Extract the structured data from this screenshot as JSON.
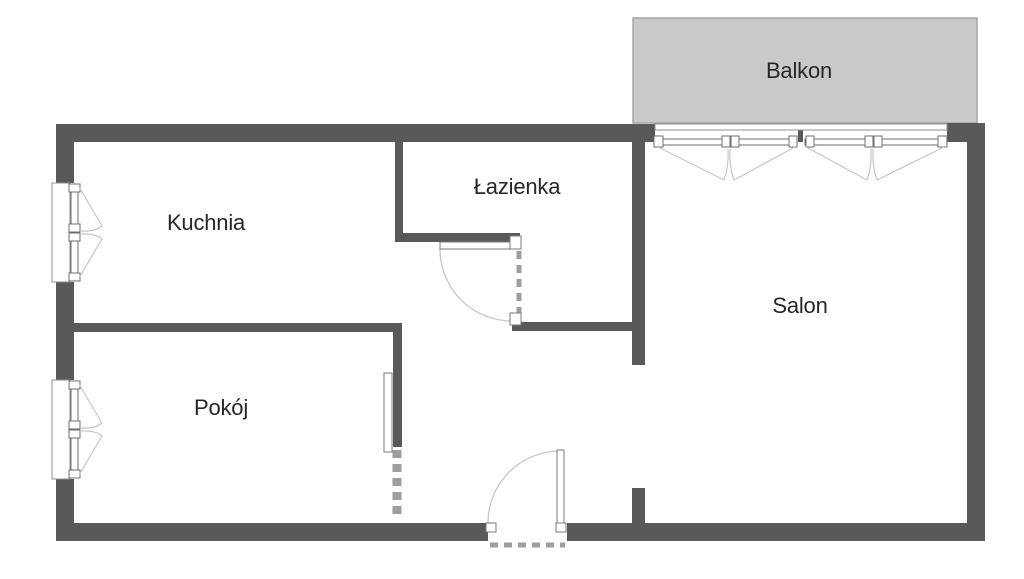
{
  "canvas": {
    "width": 1024,
    "height": 579
  },
  "colors": {
    "wall": "#595959",
    "balcony_fill": "#c9c9c9",
    "balcony_stroke": "#a6a6a6",
    "white": "#ffffff",
    "frame": "#6e6e6e",
    "frame_light": "#8f8f8f",
    "door_frame": "#7a7a7a",
    "swing": "#c6c6c6",
    "dash": "#9e9e9e",
    "label_text": "#262626"
  },
  "rooms": [
    {
      "id": "balkon",
      "name": "Balkon",
      "x": 799,
      "y": 71
    },
    {
      "id": "kuchnia",
      "name": "Kuchnia",
      "x": 206,
      "y": 223
    },
    {
      "id": "lazienka",
      "name": "Łazienka",
      "x": 517,
      "y": 187
    },
    {
      "id": "pokoj",
      "name": "Pokój",
      "x": 221,
      "y": 408
    },
    {
      "id": "salon",
      "name": "Salon",
      "x": 800,
      "y": 306
    }
  ],
  "shapes": [
    {
      "n": "balcony-slab",
      "t": "rect",
      "x": 633,
      "y": 18,
      "w": 344,
      "h": 105,
      "f": "balcony_fill",
      "s": "balcony_stroke",
      "sw": 1.5
    },
    {
      "n": "wall-top",
      "t": "rect",
      "x": 56,
      "y": 124,
      "w": 599,
      "h": 18,
      "f": "wall"
    },
    {
      "n": "wall-top-mullion",
      "t": "rect",
      "x": 798,
      "y": 124,
      "w": 5,
      "h": 18,
      "f": "wall"
    },
    {
      "n": "wall-top-right",
      "t": "rect",
      "x": 947,
      "y": 123,
      "w": 38,
      "h": 19,
      "f": "wall"
    },
    {
      "n": "wall-left-upper",
      "t": "rect",
      "x": 56,
      "y": 124,
      "w": 18,
      "h": 59,
      "f": "wall"
    },
    {
      "n": "wall-left-middle",
      "t": "rect",
      "x": 56,
      "y": 282,
      "w": 18,
      "h": 98,
      "f": "wall"
    },
    {
      "n": "wall-left-lower",
      "t": "rect",
      "x": 56,
      "y": 479,
      "w": 18,
      "h": 62,
      "f": "wall"
    },
    {
      "n": "wall-right",
      "t": "rect",
      "x": 967,
      "y": 123,
      "w": 18,
      "h": 418,
      "f": "wall"
    },
    {
      "n": "wall-bottom-left",
      "t": "rect",
      "x": 56,
      "y": 523,
      "w": 432,
      "h": 18,
      "f": "wall"
    },
    {
      "n": "wall-bottom-right",
      "t": "rect",
      "x": 567,
      "y": 523,
      "w": 418,
      "h": 18,
      "f": "wall"
    },
    {
      "n": "wall-bathroom-west",
      "t": "rect",
      "x": 395,
      "y": 142,
      "w": 8,
      "h": 100,
      "f": "wall"
    },
    {
      "n": "wall-bathroom-south",
      "t": "rect",
      "x": 395,
      "y": 233,
      "w": 125,
      "h": 9,
      "f": "wall"
    },
    {
      "n": "wall-hall-south",
      "t": "rect",
      "x": 512,
      "y": 322,
      "w": 133,
      "h": 9,
      "f": "wall"
    },
    {
      "n": "wall-salon-west-upper",
      "t": "rect",
      "x": 632,
      "y": 142,
      "w": 13,
      "h": 223,
      "f": "wall"
    },
    {
      "n": "wall-salon-west-lower",
      "t": "rect",
      "x": 632,
      "y": 488,
      "w": 13,
      "h": 35,
      "f": "wall"
    },
    {
      "n": "wall-room-divider",
      "t": "rect",
      "x": 74,
      "y": 323,
      "w": 328,
      "h": 9,
      "f": "wall"
    },
    {
      "n": "wall-pokoj-east",
      "t": "rect",
      "x": 393,
      "y": 323,
      "w": 9,
      "h": 124,
      "f": "wall"
    },
    {
      "n": "window-kitchen-sill",
      "t": "rect",
      "x": 52,
      "y": 183,
      "w": 18,
      "h": 99,
      "f": "white",
      "s": "frame_light",
      "sw": 1
    },
    {
      "n": "window-kitchen-pane",
      "t": "rect",
      "x": 71,
      "y": 185,
      "w": 7,
      "h": 95,
      "f": "white",
      "s": "frame",
      "sw": 1
    },
    {
      "n": "window-kitchen-handle",
      "t": "rect",
      "x": 69,
      "y": 184,
      "w": 11,
      "h": 8,
      "f": "white",
      "s": "frame",
      "sw": 1
    },
    {
      "n": "window-kitchen-handle",
      "t": "rect",
      "x": 69,
      "y": 224,
      "w": 11,
      "h": 8,
      "f": "white",
      "s": "frame",
      "sw": 1
    },
    {
      "n": "window-kitchen-handle",
      "t": "rect",
      "x": 69,
      "y": 233,
      "w": 11,
      "h": 8,
      "f": "white",
      "s": "frame",
      "sw": 1
    },
    {
      "n": "window-kitchen-handle",
      "t": "rect",
      "x": 69,
      "y": 273,
      "w": 11,
      "h": 8,
      "f": "white",
      "s": "frame",
      "sw": 1
    },
    {
      "n": "window-kitchen-swing",
      "t": "path",
      "d": "M79,187 L102,226",
      "s": "swing",
      "sw": 1.2
    },
    {
      "n": "window-kitchen-swing",
      "t": "path",
      "d": "M102,226 Q95,232 80,231",
      "s": "swing",
      "sw": 1.2
    },
    {
      "n": "window-kitchen-swing",
      "t": "path",
      "d": "M79,278 L102,239",
      "s": "swing",
      "sw": 1.2
    },
    {
      "n": "window-kitchen-swing",
      "t": "path",
      "d": "M102,239 Q95,233 80,234",
      "s": "swing",
      "sw": 1.2
    },
    {
      "n": "window-pokoj-sill",
      "t": "rect",
      "x": 52,
      "y": 380,
      "w": 18,
      "h": 99,
      "f": "white",
      "s": "frame_light",
      "sw": 1
    },
    {
      "n": "window-pokoj-pane",
      "t": "rect",
      "x": 71,
      "y": 382,
      "w": 7,
      "h": 95,
      "f": "white",
      "s": "frame",
      "sw": 1
    },
    {
      "n": "window-pokoj-handle",
      "t": "rect",
      "x": 69,
      "y": 381,
      "w": 11,
      "h": 8,
      "f": "white",
      "s": "frame",
      "sw": 1
    },
    {
      "n": "window-pokoj-handle",
      "t": "rect",
      "x": 69,
      "y": 421,
      "w": 11,
      "h": 8,
      "f": "white",
      "s": "frame",
      "sw": 1
    },
    {
      "n": "window-pokoj-handle",
      "t": "rect",
      "x": 69,
      "y": 430,
      "w": 11,
      "h": 8,
      "f": "white",
      "s": "frame",
      "sw": 1
    },
    {
      "n": "window-pokoj-handle",
      "t": "rect",
      "x": 69,
      "y": 470,
      "w": 11,
      "h": 8,
      "f": "white",
      "s": "frame",
      "sw": 1
    },
    {
      "n": "window-pokoj-swing",
      "t": "path",
      "d": "M79,384 L102,423",
      "s": "swing",
      "sw": 1.2
    },
    {
      "n": "window-pokoj-swing",
      "t": "path",
      "d": "M102,423 Q95,429 80,428",
      "s": "swing",
      "sw": 1.2
    },
    {
      "n": "window-pokoj-swing",
      "t": "path",
      "d": "M79,475 L102,436",
      "s": "swing",
      "sw": 1.2
    },
    {
      "n": "window-pokoj-swing",
      "t": "path",
      "d": "M102,436 Q95,430 80,431",
      "s": "swing",
      "sw": 1.2
    },
    {
      "n": "balcony-window-sill",
      "t": "rect",
      "x": 655,
      "y": 124,
      "w": 292,
      "h": 6,
      "f": "white",
      "s": "frame_light",
      "sw": 1
    },
    {
      "n": "balcony-window-pane-left",
      "t": "rect",
      "x": 657,
      "y": 139,
      "w": 139,
      "h": 6,
      "f": "white",
      "s": "frame",
      "sw": 1
    },
    {
      "n": "balcony-window-pane-right",
      "t": "rect",
      "x": 805,
      "y": 139,
      "w": 140,
      "h": 6,
      "f": "white",
      "s": "frame",
      "sw": 1
    },
    {
      "n": "balcony-window-handle",
      "t": "rect",
      "x": 654,
      "y": 136,
      "w": 9,
      "h": 11,
      "f": "white",
      "s": "frame",
      "sw": 1
    },
    {
      "n": "balcony-window-handle",
      "t": "rect",
      "x": 722,
      "y": 136,
      "w": 8,
      "h": 11,
      "f": "white",
      "s": "frame",
      "sw": 1
    },
    {
      "n": "balcony-window-handle",
      "t": "rect",
      "x": 731,
      "y": 136,
      "w": 8,
      "h": 11,
      "f": "white",
      "s": "frame",
      "sw": 1
    },
    {
      "n": "balcony-window-handle",
      "t": "rect",
      "x": 789,
      "y": 136,
      "w": 8,
      "h": 11,
      "f": "white",
      "s": "frame",
      "sw": 1
    },
    {
      "n": "balcony-window-handle",
      "t": "rect",
      "x": 806,
      "y": 136,
      "w": 8,
      "h": 11,
      "f": "white",
      "s": "frame",
      "sw": 1
    },
    {
      "n": "balcony-window-handle",
      "t": "rect",
      "x": 865,
      "y": 136,
      "w": 8,
      "h": 11,
      "f": "white",
      "s": "frame",
      "sw": 1
    },
    {
      "n": "balcony-window-handle",
      "t": "rect",
      "x": 874,
      "y": 136,
      "w": 8,
      "h": 11,
      "f": "white",
      "s": "frame",
      "sw": 1
    },
    {
      "n": "balcony-window-handle",
      "t": "rect",
      "x": 938,
      "y": 136,
      "w": 9,
      "h": 11,
      "f": "white",
      "s": "frame",
      "sw": 1
    },
    {
      "n": "balcony-window-swing",
      "t": "path",
      "d": "M658,147 L724,180",
      "s": "swing",
      "sw": 1.2
    },
    {
      "n": "balcony-window-swing",
      "t": "path",
      "d": "M724,180 Q729,166 728,149",
      "s": "swing",
      "sw": 1.2
    },
    {
      "n": "balcony-window-swing",
      "t": "path",
      "d": "M795,147 L734,180",
      "s": "swing",
      "sw": 1.2
    },
    {
      "n": "balcony-window-swing",
      "t": "path",
      "d": "M734,180 Q729,166 730,149",
      "s": "swing",
      "sw": 1.2
    },
    {
      "n": "balcony-window-swing",
      "t": "path",
      "d": "M806,147 L867,180",
      "s": "swing",
      "sw": 1.2
    },
    {
      "n": "balcony-window-swing",
      "t": "path",
      "d": "M867,180 Q872,166 871,149",
      "s": "swing",
      "sw": 1.2
    },
    {
      "n": "balcony-window-swing",
      "t": "path",
      "d": "M944,147 L877,180",
      "s": "swing",
      "sw": 1.2
    },
    {
      "n": "balcony-window-swing",
      "t": "path",
      "d": "M877,180 Q872,166 873,149",
      "s": "swing",
      "sw": 1.2
    },
    {
      "n": "bathroom-door-opening-dash",
      "t": "line",
      "x1": 519,
      "y1": 251,
      "x2": 519,
      "y2": 313,
      "s": "dash",
      "sw": 5,
      "da": "8 6"
    },
    {
      "n": "bathroom-door-swing-arc",
      "t": "path",
      "d": "M440,249 A72,72 0 0 0 512,321",
      "s": "swing",
      "sw": 1.3
    },
    {
      "n": "bathroom-door-leaf",
      "t": "rect",
      "x": 440,
      "y": 242,
      "w": 76,
      "h": 7,
      "f": "white",
      "s": "door_frame",
      "sw": 1
    },
    {
      "n": "bathroom-door-pivot",
      "t": "rect",
      "x": 510,
      "y": 236,
      "w": 11,
      "h": 13,
      "f": "white",
      "s": "door_frame",
      "sw": 1
    },
    {
      "n": "bathroom-door-pivot",
      "t": "rect",
      "x": 510,
      "y": 313,
      "w": 11,
      "h": 12,
      "f": "white",
      "s": "door_frame",
      "sw": 1
    },
    {
      "n": "pokoj-door-opening-dash",
      "t": "line",
      "x1": 397,
      "y1": 450,
      "x2": 397,
      "y2": 520,
      "s": "dash",
      "sw": 9,
      "da": "8 6"
    },
    {
      "n": "pokoj-door-leaf",
      "t": "rect",
      "x": 384,
      "y": 373,
      "w": 8,
      "h": 79,
      "f": "white",
      "s": "door_frame",
      "sw": 1
    },
    {
      "n": "entrance-threshold-dash",
      "t": "line",
      "x1": 490,
      "y1": 545,
      "x2": 565,
      "y2": 545,
      "s": "dash",
      "sw": 5,
      "da": "8 6"
    },
    {
      "n": "entrance-door-swing-arc",
      "t": "path",
      "d": "M560,451 A72,72 0 0 0 488,523",
      "s": "swing",
      "sw": 1.3
    },
    {
      "n": "entrance-door-leaf",
      "t": "rect",
      "x": 557,
      "y": 450,
      "w": 7,
      "h": 74,
      "f": "white",
      "s": "door_frame",
      "sw": 1
    },
    {
      "n": "entrance-door-hinge",
      "t": "rect",
      "x": 486,
      "y": 523,
      "w": 10,
      "h": 9,
      "f": "white",
      "s": "door_frame",
      "sw": 1
    },
    {
      "n": "entrance-door-hinge",
      "t": "rect",
      "x": 556,
      "y": 523,
      "w": 10,
      "h": 9,
      "f": "white",
      "s": "door_frame",
      "sw": 1
    }
  ]
}
